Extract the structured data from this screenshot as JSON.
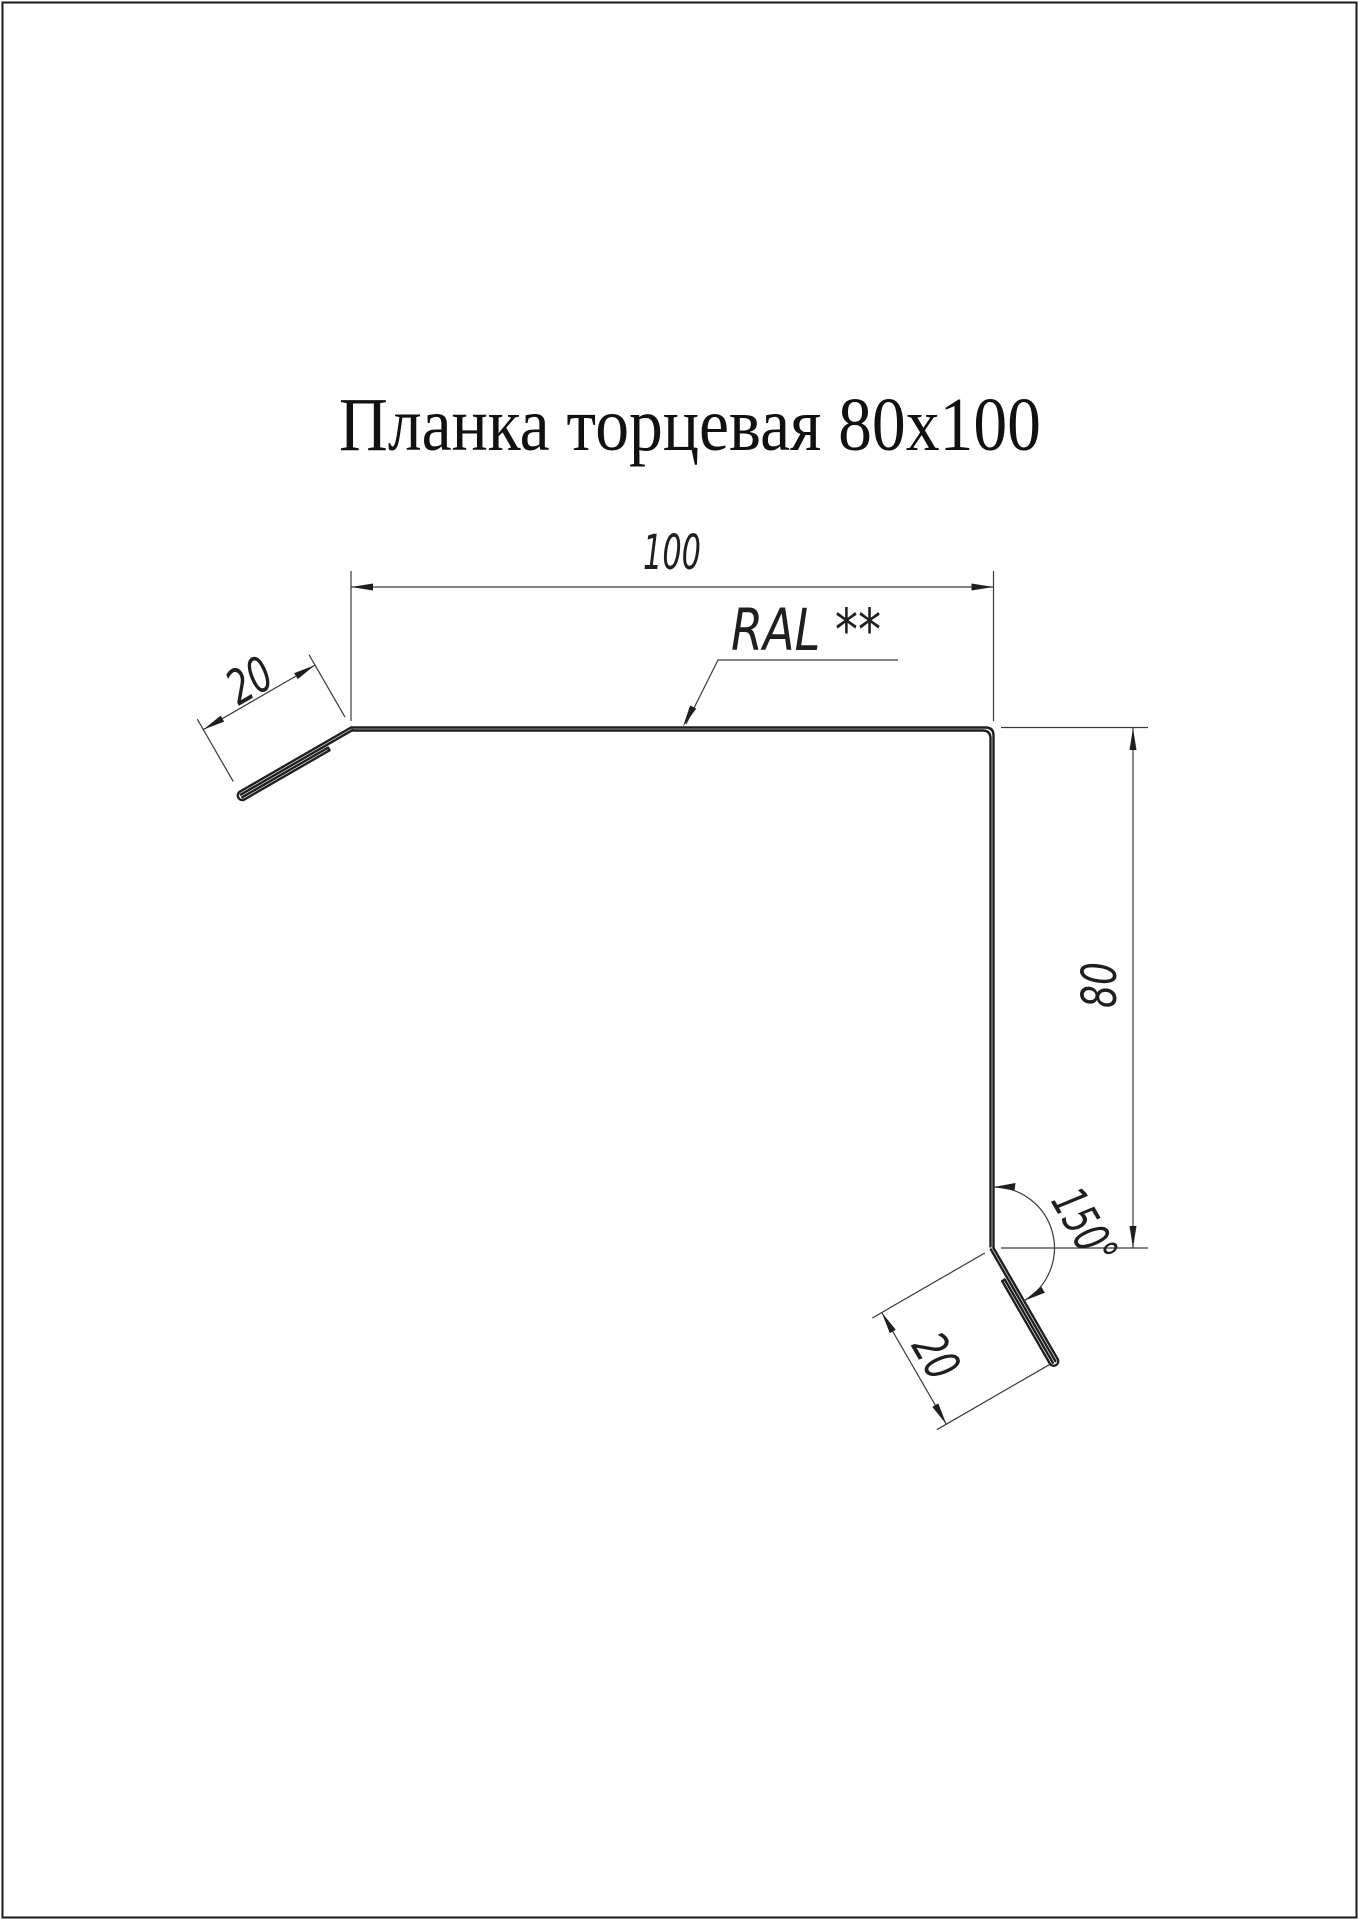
{
  "title": "Планка торцевая 80x100",
  "dimensions": {
    "top_width": "100",
    "right_height": "80",
    "top_flange": "20",
    "bottom_flange": "20",
    "bend_angle": "150°"
  },
  "labels": {
    "color_note": "RAL **"
  },
  "colors": {
    "profile_line": "#1f1f1f",
    "dimension_line": "#3a3a3a",
    "text": "#1f1f1f",
    "background": "#ffffff",
    "page_border": "#1a1a1a"
  }
}
